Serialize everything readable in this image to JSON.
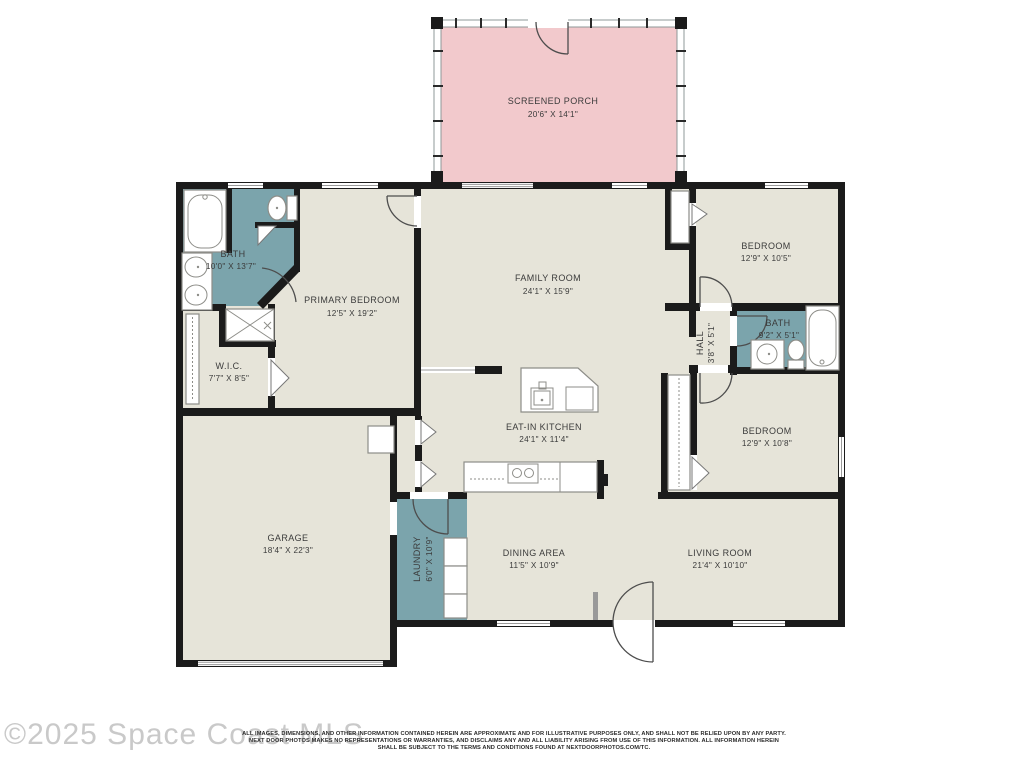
{
  "colors": {
    "wall": "#1b1b1b",
    "room_fill": "#e6e4d9",
    "wet_room_fill": "#7ba4ac",
    "porch_fill": "#f2c9cc",
    "label_text": "#3b3b3b",
    "watermark": "#c9c9c9"
  },
  "rooms": {
    "screened_porch": {
      "name": "SCREENED PORCH",
      "dims": "20'6\" X 14'1\""
    },
    "family_room": {
      "name": "FAMILY ROOM",
      "dims": "24'1\" X 15'9\""
    },
    "primary_bedroom": {
      "name": "PRIMARY BEDROOM",
      "dims": "12'5\" X 19'2\""
    },
    "primary_bath": {
      "name": "BATH",
      "dims": "10'0\" X 13'7\""
    },
    "wic": {
      "name": "W.I.C.",
      "dims": "7'7\" X 8'5\""
    },
    "garage": {
      "name": "GARAGE",
      "dims": "18'4\" X 22'3\""
    },
    "eat_in_kitchen": {
      "name": "EAT-IN KITCHEN",
      "dims": "24'1\" X 11'4\""
    },
    "laundry": {
      "name": "LAUNDRY",
      "dims": "6'0\" X 10'9\""
    },
    "dining_area": {
      "name": "DINING AREA",
      "dims": "11'5\" X 10'9\""
    },
    "living_room": {
      "name": "LIVING ROOM",
      "dims": "21'4\" X 10'10\""
    },
    "bedroom_1": {
      "name": "BEDROOM",
      "dims": "12'9\" X 10'5\""
    },
    "hall_bath": {
      "name": "BATH",
      "dims": "9'2\" X 5'1\""
    },
    "hall": {
      "name": "HALL",
      "dims": "3'8\" X 5'1\""
    },
    "bedroom_2": {
      "name": "BEDROOM",
      "dims": "12'9\" X 10'8\""
    }
  },
  "watermark": {
    "text": "©2025 Space Coast MLS"
  },
  "disclaimer": {
    "line1": "ALL IMAGES, DIMENSIONS, AND OTHER INFORMATION CONTAINED HEREIN ARE APPROXIMATE AND FOR ILLUSTRATIVE PURPOSES ONLY, AND SHALL NOT BE RELIED UPON BY ANY PARTY.",
    "line2": "NEXT DOOR PHOTOS MAKES NO REPRESENTATIONS OR WARRANTIES, AND DISCLAIMS ANY AND ALL LIABILITY ARISING FROM USE OF THIS INFORMATION. ALL INFORMATION HEREIN",
    "line3": "SHALL BE SUBJECT TO THE TERMS AND CONDITIONS FOUND AT NEXTDOORPHOTOS.COM/TC."
  }
}
